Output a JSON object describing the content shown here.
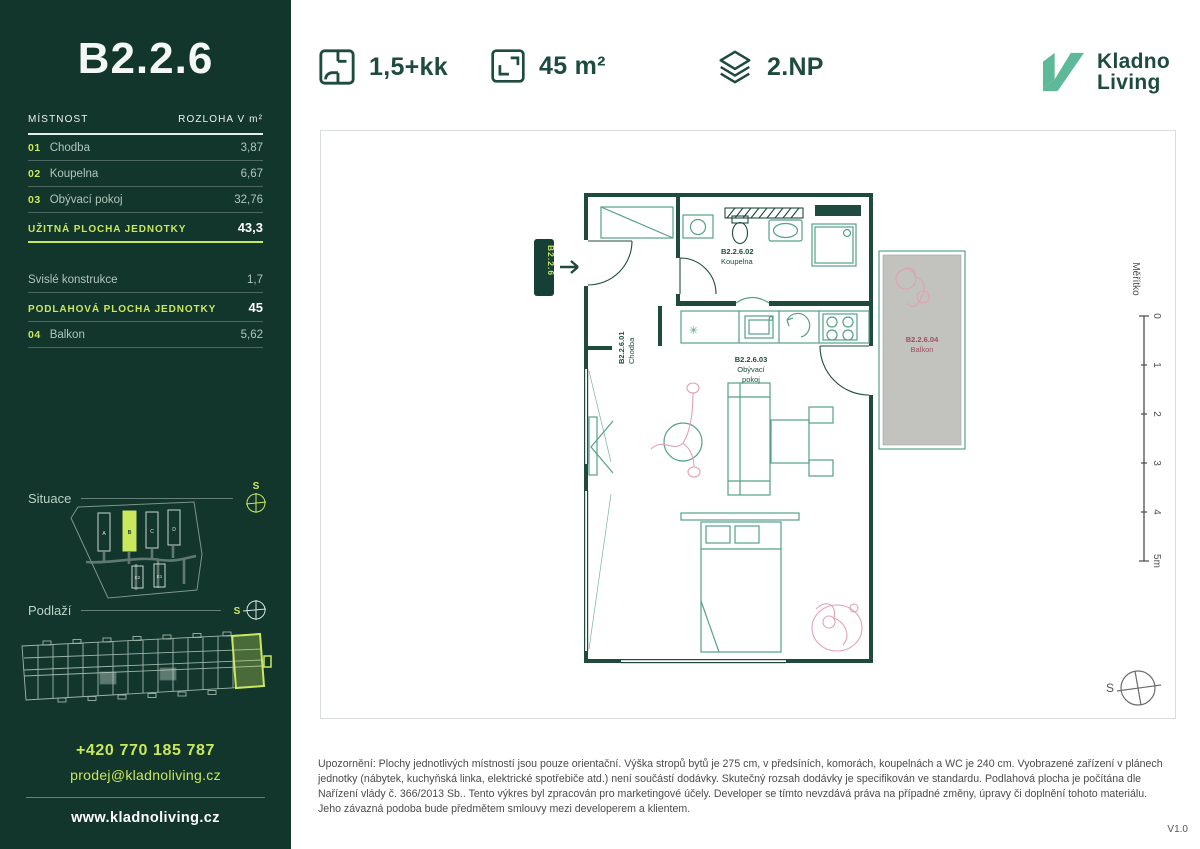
{
  "header": {
    "layout": "1,5+kk",
    "area": "45 m²",
    "floor": "2.NP",
    "brand": {
      "line1": "Kladno",
      "line2": "Living"
    }
  },
  "sidebar": {
    "unit_title": "B2.2.6",
    "table_header": {
      "room": "MÍSTNOST",
      "area": "ROZLOHA V m²"
    },
    "rooms": [
      {
        "num": "01",
        "name": "Chodba",
        "area": "3,87"
      },
      {
        "num": "02",
        "name": "Koupelna",
        "area": "6,67"
      },
      {
        "num": "03",
        "name": "Obývací pokoj",
        "area": "32,76"
      }
    ],
    "usable": {
      "label": "UŽITNÁ PLOCHA JEDNOTKY",
      "value": "43,3"
    },
    "vertical": {
      "label": "Svislé konstrukce",
      "value": "1,7"
    },
    "floor_area": {
      "label": "PODLAHOVÁ PLOCHA JEDNOTKY",
      "value": "45"
    },
    "balcony": {
      "num": "04",
      "name": "Balkon",
      "area": "5,62"
    },
    "situace_label": "Situace",
    "podlazi_label": "Podlaží",
    "compass_letter": "S",
    "site_buildings": {
      "a": "A",
      "b": "B",
      "c": "C",
      "d": "D",
      "e2": "E2",
      "e1": "E1"
    },
    "contact": {
      "phone": "+420 770 185 787",
      "email": "prodej@kladnoliving.cz",
      "web": "www.kladnoliving.cz"
    }
  },
  "plan": {
    "entry_tag": "B2.2.6",
    "rooms": {
      "chodba": {
        "id": "B2.2.6.01",
        "name": "Chodba"
      },
      "koupelna": {
        "id": "B2.2.6.02",
        "name": "Koupelna"
      },
      "obyvaci": {
        "id": "B2.2.6.03",
        "name1": "Obývací",
        "name2": "pokoj"
      },
      "balkon": {
        "id": "B2.2.6.04",
        "name": "Balkon"
      }
    },
    "scale": {
      "label": "Měřítko",
      "t0": "0",
      "t1": "1",
      "t2": "2",
      "t3": "3",
      "t4": "4",
      "t5": "5m"
    },
    "compass_letter": "S"
  },
  "footer": {
    "disclaimer": "Upozornění: Plochy jednotlivých místností jsou pouze orientační. Výška stropů bytů je 275 cm, v předsíních, komorách, koupelnách a WC je 240 cm. Vyobrazené zařízení v plánech jednotky (nábytek, kuchyňská linka, elektrické spotřebiče atd.) není součástí dodávky. Skutečný rozsah dodávky je specifikován ve standardu. Podlahová plocha je počítána dle Nařízení vlády č. 366/2013 Sb.. Tento výkres byl zpracován pro marketingové účely. Developer se tímto nevzdává práva na případné změny, úpravy či doplnění tohoto materiálu. Jeho závazná podoba bude předmětem smlouvy mezi developerem a klientem.",
    "version": "V1.0"
  },
  "colors": {
    "sidebar_bg": "#12352C",
    "accent_lime": "#C9E85C",
    "dark_green": "#1E4B3F",
    "logo_teal": "#5EB998",
    "plan_pink": "#E0A2B2",
    "balcony_fill": "#C2C3BF",
    "balcony_label": "#A04E5E"
  }
}
